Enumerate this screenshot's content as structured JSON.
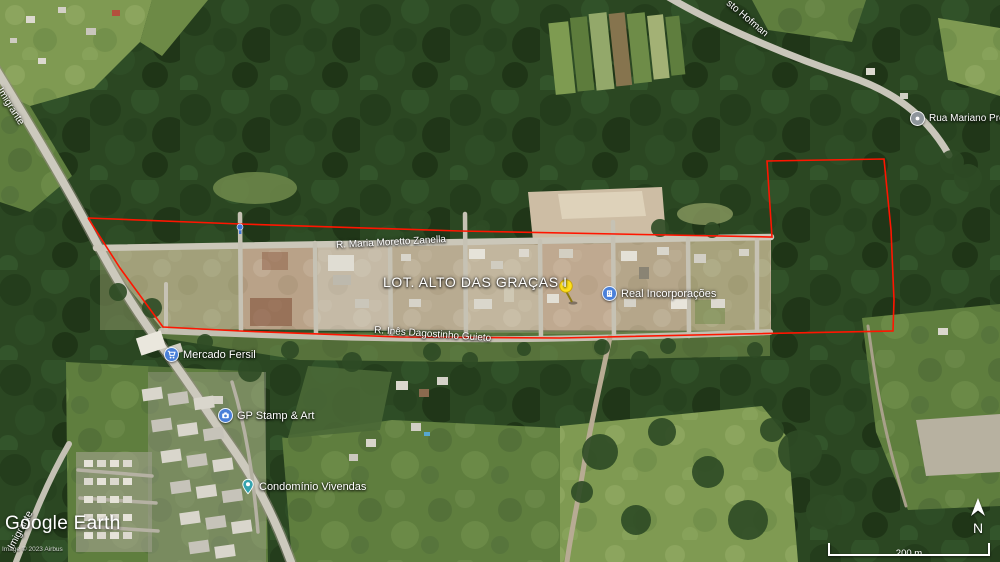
{
  "app": {
    "logo_text": "Google Earth",
    "copyright": "Image © 2023 Airbus"
  },
  "placemark": {
    "label": "LOT. ALTO DAS GRAÇAS I",
    "pin_color": "#ffe11a"
  },
  "boundary": {
    "color": "#ff1500"
  },
  "streets": [
    {
      "label": "R. Maria Moretto Zanella"
    },
    {
      "label": "R. Inês Dagostinho Guieto"
    },
    {
      "label": "Imigrante"
    },
    {
      "label": "Imigrante"
    },
    {
      "label": "sto Hofman"
    }
  ],
  "pois": [
    {
      "label": "Mercado Fersil",
      "icon": "shopping-cart-icon",
      "color": "#4a80d9"
    },
    {
      "label": "GP Stamp & Art",
      "icon": "camera-icon",
      "color": "#4a80d9"
    },
    {
      "label": "Real Incorporações",
      "icon": "building-icon",
      "color": "#4a80d9"
    },
    {
      "label": "Condomínio Vivendas",
      "icon": "place-pin-icon",
      "color": "#35a3ae"
    },
    {
      "label": "Rua Mariano Pretto",
      "icon": "road-pin-icon",
      "color": "#8e959b"
    }
  ],
  "hud": {
    "compass": "N",
    "scale": "200 m"
  }
}
